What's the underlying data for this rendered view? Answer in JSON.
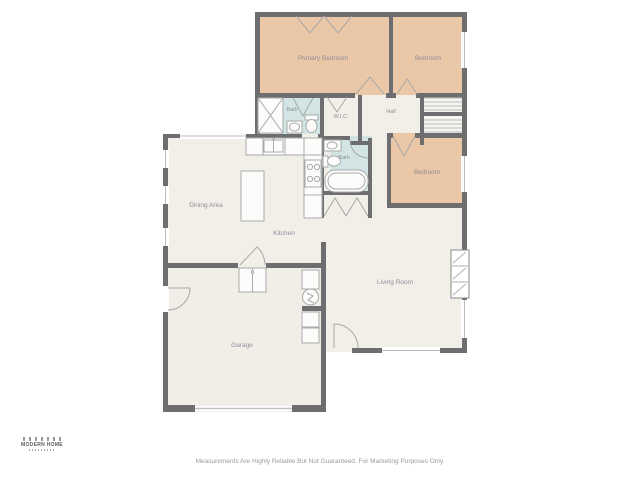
{
  "floorplan": {
    "rooms": {
      "primary_bedroom": "Primary Bedroom",
      "bedroom_top_right": "Bedroom",
      "bath_upper": "Bath",
      "wic": "W.I.C.",
      "hall": "Hall",
      "bedroom_right": "Bedroom",
      "bath_middle": "Bath",
      "dining_area": "Dining Area",
      "kitchen": "Kitchen",
      "living_room": "Living Room",
      "garage": "Garage"
    },
    "palette": {
      "bedroom_fill": "#e9c7a7",
      "bathroom_fill": "#d2e5e4",
      "floor_fill": "#f2efe9",
      "wall": "#6e6e71",
      "label_text": "#8f8f98"
    }
  },
  "branding": {
    "logo_name": "MODERN HOME"
  },
  "footer": {
    "disclaimer": "Measurements Are Highly Reliable But Not Guaranteed. For Marketing Purposes Only."
  }
}
